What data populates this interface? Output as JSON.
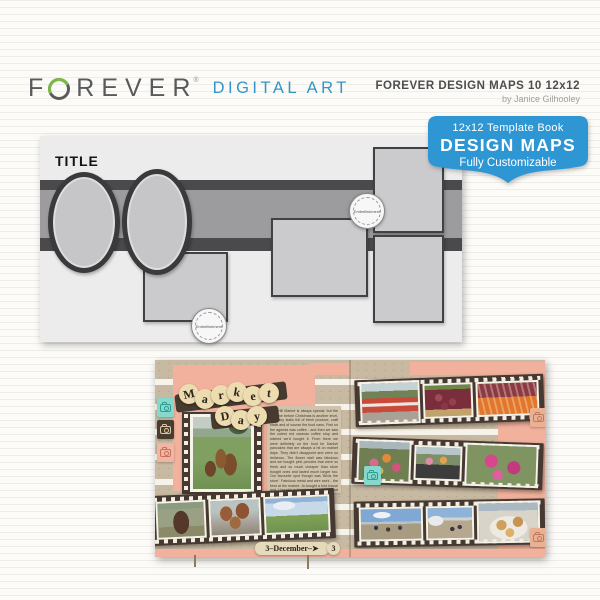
{
  "header": {
    "logo": {
      "part1": "F",
      "part2": "REVER",
      "trademark": "®",
      "subbrand": "DIGITAL ART"
    },
    "product": {
      "title": "FOREVER DESIGN MAPS 10 12x12",
      "byline": "by Janice Gilhooley"
    }
  },
  "badge": {
    "line1": "12x12 Template Book",
    "line2": "DESIGN MAPS",
    "line3": "Fully Customizable",
    "color": "#2f96d4"
  },
  "template_map": {
    "title": "TITLE",
    "embellishment_label": "Embellishment",
    "placeholders": [
      "ellipse-photo-1",
      "ellipse-photo-2",
      "square-photo",
      "tall-photo-top-right",
      "wide-photo-center",
      "tall-photo-bottom-right",
      "banner-strip"
    ]
  },
  "scrapbook": {
    "left": {
      "title_word1": [
        "M",
        "a",
        "r",
        "k",
        "e",
        "t"
      ],
      "title_word2": [
        "D",
        "a",
        "y"
      ],
      "journal": "Red Hill Market is always special, but the last one before Christmas is another level, so many stalls full of fresh produce, craft stalls and of course the food vans. First on the agenda was coffee - and then we saw the cutest red caravan coffee stop and wished we'd bought it. From there we were definitely on the hunt for Danish pancakes that are always a hit on market days. They didn't disappoint and were so delicious. The flower stall was fabulous and we bought pink peonies that were so fresh and so much cheaper than store bought ones and lasted much longer too. Our favourite spot though was 'Birds the store'. Fabulous metal and wire work - the best at the market. Jo bought a bird house and I bought a hanging metal bird heart piece for Mum's Christmas present. So much to see and love about this iconic market.",
      "date_label": "3–December–➤",
      "date_tag": "3",
      "photos": [
        "birdhouse garden display",
        "market sign",
        "birdhouse stall",
        "market field"
      ]
    },
    "right": {
      "photos": [
        "red caravan coffee van",
        "red onions stall",
        "beetroot and carrots",
        "flower bouquets",
        "flower buckets",
        "pink flowers",
        "market crowd",
        "market walkway",
        "sugared pastries"
      ]
    },
    "colors": {
      "kraft": "#c8baa2",
      "salmon": "#f1b19c",
      "film_brown": "#463931",
      "teal_stamp": "#86d8cd",
      "letter_circle": "#ecdcb0"
    }
  }
}
